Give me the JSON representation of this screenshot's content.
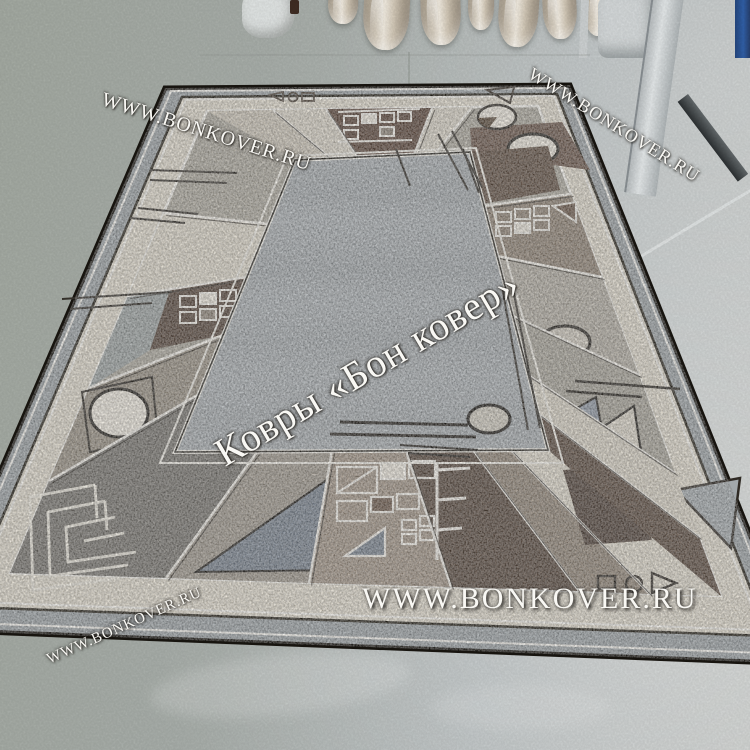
{
  "watermarks": {
    "site_url": "WWW.BONKOVER.RU",
    "brand_caption": "Ковры «Бон ковер»",
    "instances": [
      {
        "role": "top-left-diagonal",
        "text": "WWW.BONKOVER.RU"
      },
      {
        "role": "top-right-diagonal",
        "text": "WWW.BONKOVER.RU"
      },
      {
        "role": "center-diagonal",
        "text": "Ковры «Бон ковер»"
      },
      {
        "role": "bottom-horizontal",
        "text": "WWW.BONKOVER.RU"
      },
      {
        "role": "bottom-left-diagonal",
        "text": "WWW.BONKOVER.RU"
      }
    ]
  },
  "scene": {
    "subject": "geometric bordered area rug displayed on painted concrete floor",
    "background_objects": {
      "rolled_rugs_count": 7,
      "plastic_bag": true,
      "door_frame": true,
      "blue_object": true
    },
    "palette": {
      "floor": "#aab0ab",
      "rug_field_gray": "#a7acaf",
      "rug_border_cream": "#ded8ca",
      "rug_brown_dark": "#56473c",
      "rug_beige": "#d6d0c3",
      "rug_outline_black": "#17140f",
      "watermark_white": "#f9f8f4",
      "door_metal": "#d7dbdc",
      "threshold_bar": "#2c3032",
      "blue_object": "#3160a8"
    }
  }
}
